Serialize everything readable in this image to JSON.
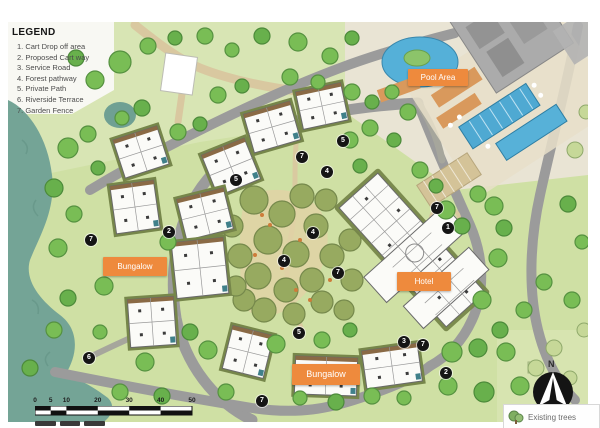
{
  "legend": {
    "title": "LEGEND",
    "items": [
      "1. Cart Drop off area",
      "2. Proposed Cart way",
      "3. Service Road",
      "4. Forest pathway",
      "5. Private Path",
      "6. Riverside Terrace",
      "7. Garden Fence"
    ]
  },
  "area_labels": [
    {
      "text": "Pool Area",
      "x": 408,
      "y": 69,
      "w": 60,
      "h": 17,
      "fs": 8
    },
    {
      "text": "Bungalow",
      "x": 103,
      "y": 257,
      "w": 64,
      "h": 19,
      "fs": 8
    },
    {
      "text": "Hotel",
      "x": 397,
      "y": 272,
      "w": 54,
      "h": 19,
      "fs": 8
    },
    {
      "text": "Bungalow",
      "x": 292,
      "y": 364,
      "w": 68,
      "h": 21,
      "fs": 9
    }
  ],
  "markers": [
    {
      "n": "5",
      "x": 343,
      "y": 141
    },
    {
      "n": "7",
      "x": 302,
      "y": 157
    },
    {
      "n": "4",
      "x": 327,
      "y": 172
    },
    {
      "n": "5",
      "x": 236,
      "y": 180
    },
    {
      "n": "7",
      "x": 437,
      "y": 208
    },
    {
      "n": "1",
      "x": 448,
      "y": 228
    },
    {
      "n": "2",
      "x": 169,
      "y": 232
    },
    {
      "n": "4",
      "x": 313,
      "y": 233
    },
    {
      "n": "7",
      "x": 91,
      "y": 240
    },
    {
      "n": "4",
      "x": 284,
      "y": 261
    },
    {
      "n": "7",
      "x": 338,
      "y": 273
    },
    {
      "n": "5",
      "x": 299,
      "y": 333
    },
    {
      "n": "6",
      "x": 89,
      "y": 358
    },
    {
      "n": "3",
      "x": 404,
      "y": 342
    },
    {
      "n": "7",
      "x": 423,
      "y": 345
    },
    {
      "n": "2",
      "x": 446,
      "y": 373
    },
    {
      "n": "7",
      "x": 262,
      "y": 401
    }
  ],
  "scale_bar": {
    "ticks": [
      0,
      5,
      10,
      20,
      30,
      40,
      50
    ]
  },
  "compass": {
    "label": "N"
  },
  "map_key": {
    "existing_trees": "Existing trees"
  },
  "colors": {
    "accent_orange": "#ee8a3d",
    "water": "#74a496",
    "road": "#9b9b9b",
    "tree_green": "#79bd55",
    "plan_background": "#cfe0a4",
    "marker_black": "#151515"
  }
}
